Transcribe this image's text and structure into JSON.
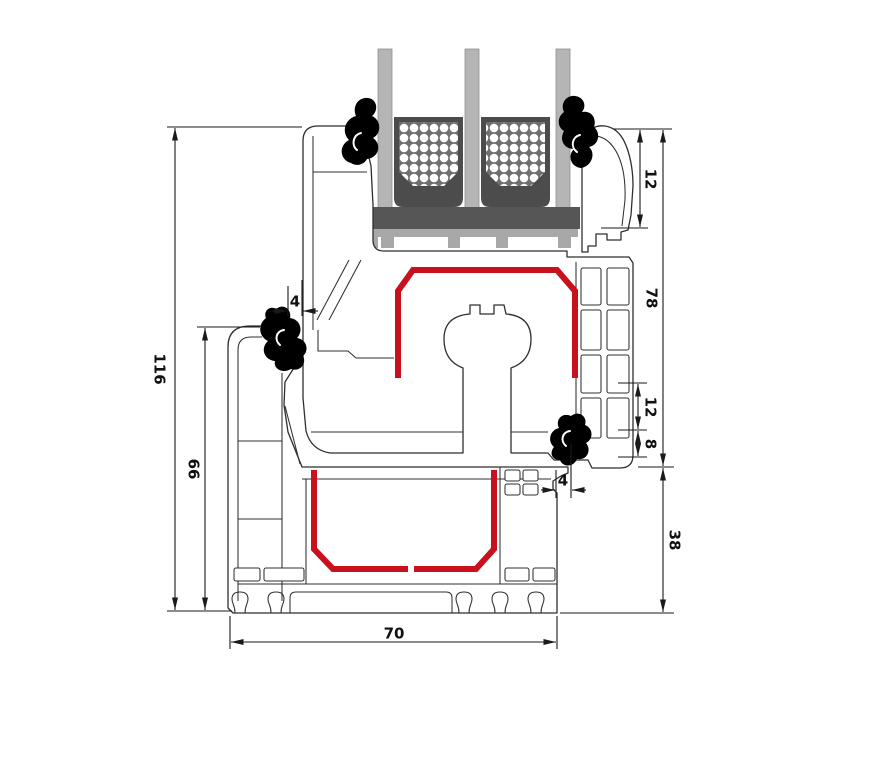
{
  "drawing": {
    "title": "Window profile cross-section",
    "type": "technical-section-diagram",
    "components": {
      "frame": "outer-frame-profile",
      "sash": "sash-profile",
      "bead": "glazing-bead",
      "glazing": "triple-glazing-unit",
      "spacers": "glazing-spacer-bars",
      "setting_block": "glazing-setting-block",
      "steel_sash": "steel-reinforcement-sash",
      "steel_frame": "steel-reinforcement-frame",
      "gaskets": "rubber-gaskets"
    },
    "dimensions": {
      "total_height": {
        "label": "116"
      },
      "frame_height": {
        "label": "66"
      },
      "overlap_left": {
        "label": "4"
      },
      "bead_height": {
        "label": "12"
      },
      "sash_height": {
        "label": "78"
      },
      "rebate_height": {
        "label": "12"
      },
      "rebate_step": {
        "label": "8"
      },
      "overlap_right": {
        "label": "4"
      },
      "base_height": {
        "label": "38"
      },
      "profile_depth": {
        "label": "70"
      }
    },
    "colors": {
      "outline": "#2f2f2f",
      "dimension": "#1a1a1a",
      "steel": "#c9101d",
      "gasket": "#000000",
      "glass": "#b5b5b5",
      "spacer_dark": "#4c4c4c",
      "spacer_inner": "#6f6f6f",
      "setting_block": "#565656",
      "support_strip": "#a8a8a8"
    }
  }
}
